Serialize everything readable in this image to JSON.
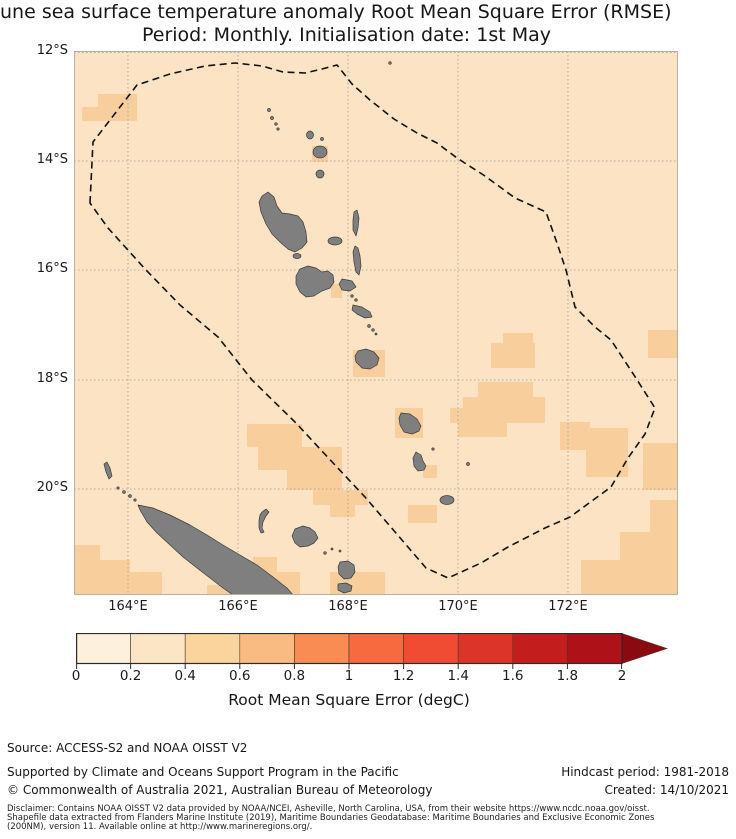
{
  "title": {
    "line1": "une sea surface temperature anomaly Root Mean Square Error (RMSE)",
    "line2": "Period: Monthly. Initialisation date: 1st May"
  },
  "map": {
    "lat_labels": [
      "12°S",
      "14°S",
      "16°S",
      "18°S",
      "20°S"
    ],
    "lon_labels": [
      "164°E",
      "166°E",
      "168°E",
      "170°E",
      "172°E"
    ],
    "base_color": "#FBE3C3",
    "patch_color": "#F8CE9D",
    "island_color": "#7F7F7F",
    "island_outline": "#3A3A3A",
    "gridline_color": "#A39B91",
    "boundary_color": "#111111",
    "border_color": "#B9B0A4"
  },
  "colorbar": {
    "ticks": [
      "0",
      "0.2",
      "0.4",
      "0.6",
      "0.8",
      "1",
      "1.2",
      "1.4",
      "1.6",
      "1.8",
      "2"
    ],
    "colors": [
      "#FDF0DC",
      "#FCE5C4",
      "#FBD49D",
      "#FABB83",
      "#F98C53",
      "#F7693F",
      "#EF4C33",
      "#DC3428",
      "#C41D1D",
      "#AE1117"
    ],
    "arrow_color": "#8B0A12",
    "edge_color": "#2A2A2A",
    "label": "Root Mean Square Error (degC)"
  },
  "footer": {
    "source": "Source: ACCESS-S2 and NOAA OISST V2",
    "supported": "Supported by Climate and Oceans Support Program in the Pacific",
    "copyright": "© Commonwealth of Australia 2021, Australian Bureau of Meteorology",
    "hindcast": "Hindcast period: 1981-2018",
    "created": "Created: 14/10/2021",
    "disclaimer_line1": "Disclaimer: Contains NOAA OISST V2 data provided by NOAA/NCEI, Asheville, North Carolina, USA, from their website https://www.ncdc.noaa.gov/oisst.",
    "disclaimer_line2": "Shapefile data extracted from Flanders Marine Institute (2019), Maritime Boundaries Geodatabase: Maritime Boundaries and Exclusive Economic Zones",
    "disclaimer_line3": "(200NM), version 11. Available online at http://www.marineregions.org/."
  },
  "chart_data": {
    "type": "heatmap",
    "title": "une sea surface temperature anomaly Root Mean Square Error (RMSE)",
    "subtitle": "Period: Monthly. Initialisation date: 1st May",
    "colorbar_label": "Root Mean Square Error (degC)",
    "colorbar_ticks": [
      0,
      0.2,
      0.4,
      0.6,
      0.8,
      1,
      1.2,
      1.4,
      1.6,
      1.8,
      2
    ],
    "colorbar_extends_above_max": true,
    "lon_axis_ticks_deg_e": [
      164,
      166,
      168,
      170,
      172
    ],
    "lat_axis_ticks_deg_s": [
      12,
      14,
      16,
      18,
      20
    ],
    "lon_range_deg_e": [
      163,
      174
    ],
    "lat_range_deg_s": [
      12,
      22
    ],
    "grid": true,
    "dominant_rmse_range_degc": [
      0.2,
      0.4
    ],
    "patch_rmse_range_degc": [
      0.4,
      0.6
    ],
    "overlay": "dashed EEZ boundary polygon around Vanuatu; gray land (Vanuatu archipelago, New Caledonia, Loyalty Islands)"
  }
}
